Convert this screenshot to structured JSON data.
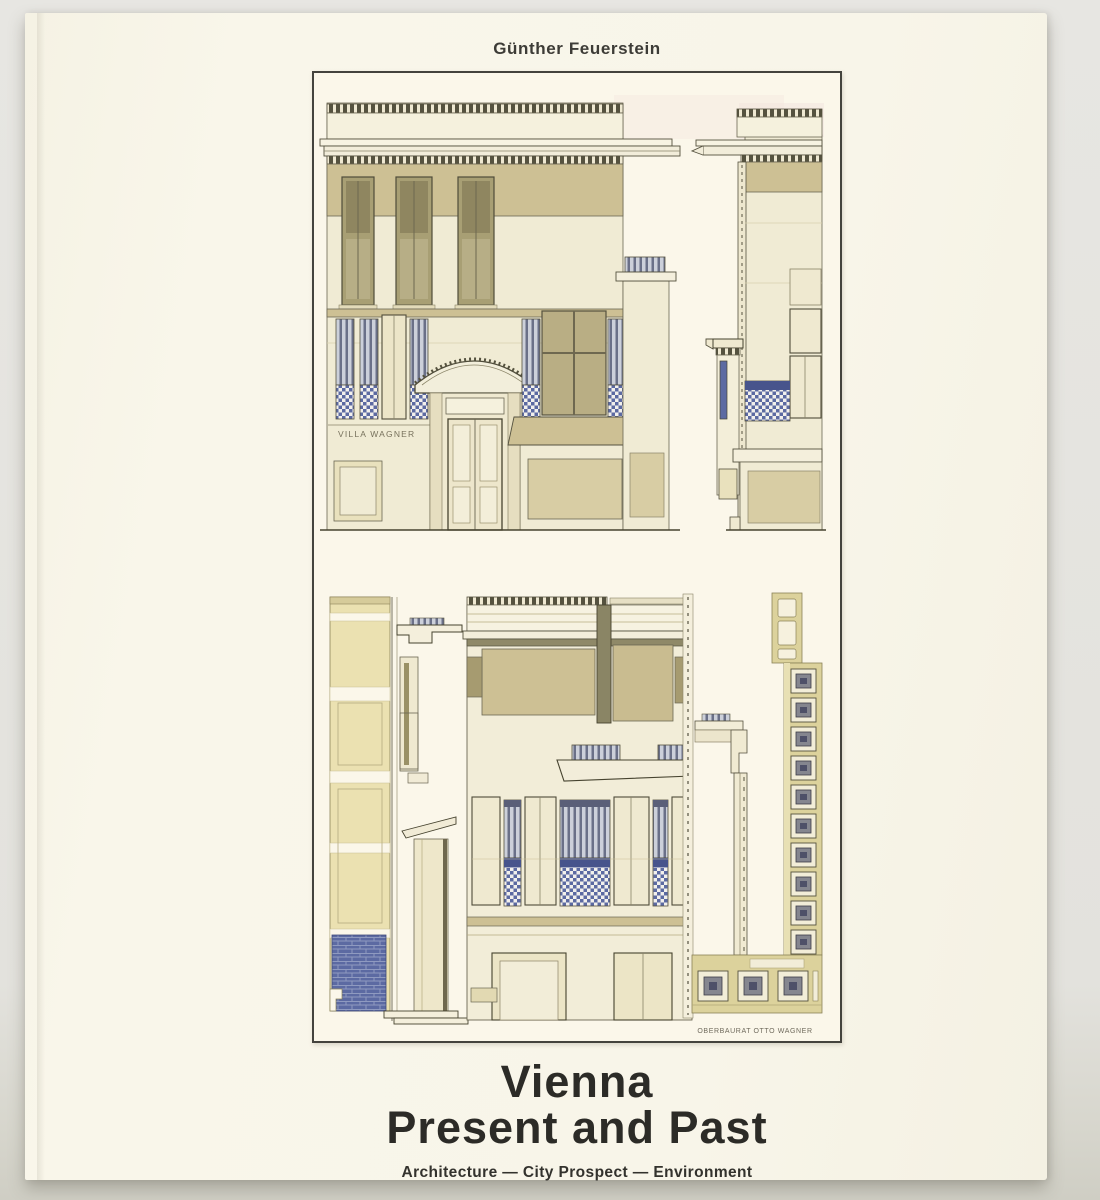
{
  "photo": {
    "background_color": "#e3e2dd"
  },
  "book": {
    "cover_color": "#f8f5e9",
    "author": "Günther Feuerstein",
    "title_line1": "Vienna",
    "title_line2": "Present and Past",
    "subtitle": "Architecture — City Prospect — Environment"
  },
  "plate": {
    "border_color": "#44433d",
    "paper_color": "#fbf7ea",
    "villa_sign": "VILLA WAGNER",
    "caption": "OBERBAURAT OTTO WAGNER",
    "palette": {
      "cream": "#f0ebd4",
      "tan": "#cdc094",
      "olive_window": "#a89f74",
      "dark_olive": "#6e6850",
      "ornament_blue": "#5c6aa2",
      "ink": "#55523f"
    }
  }
}
